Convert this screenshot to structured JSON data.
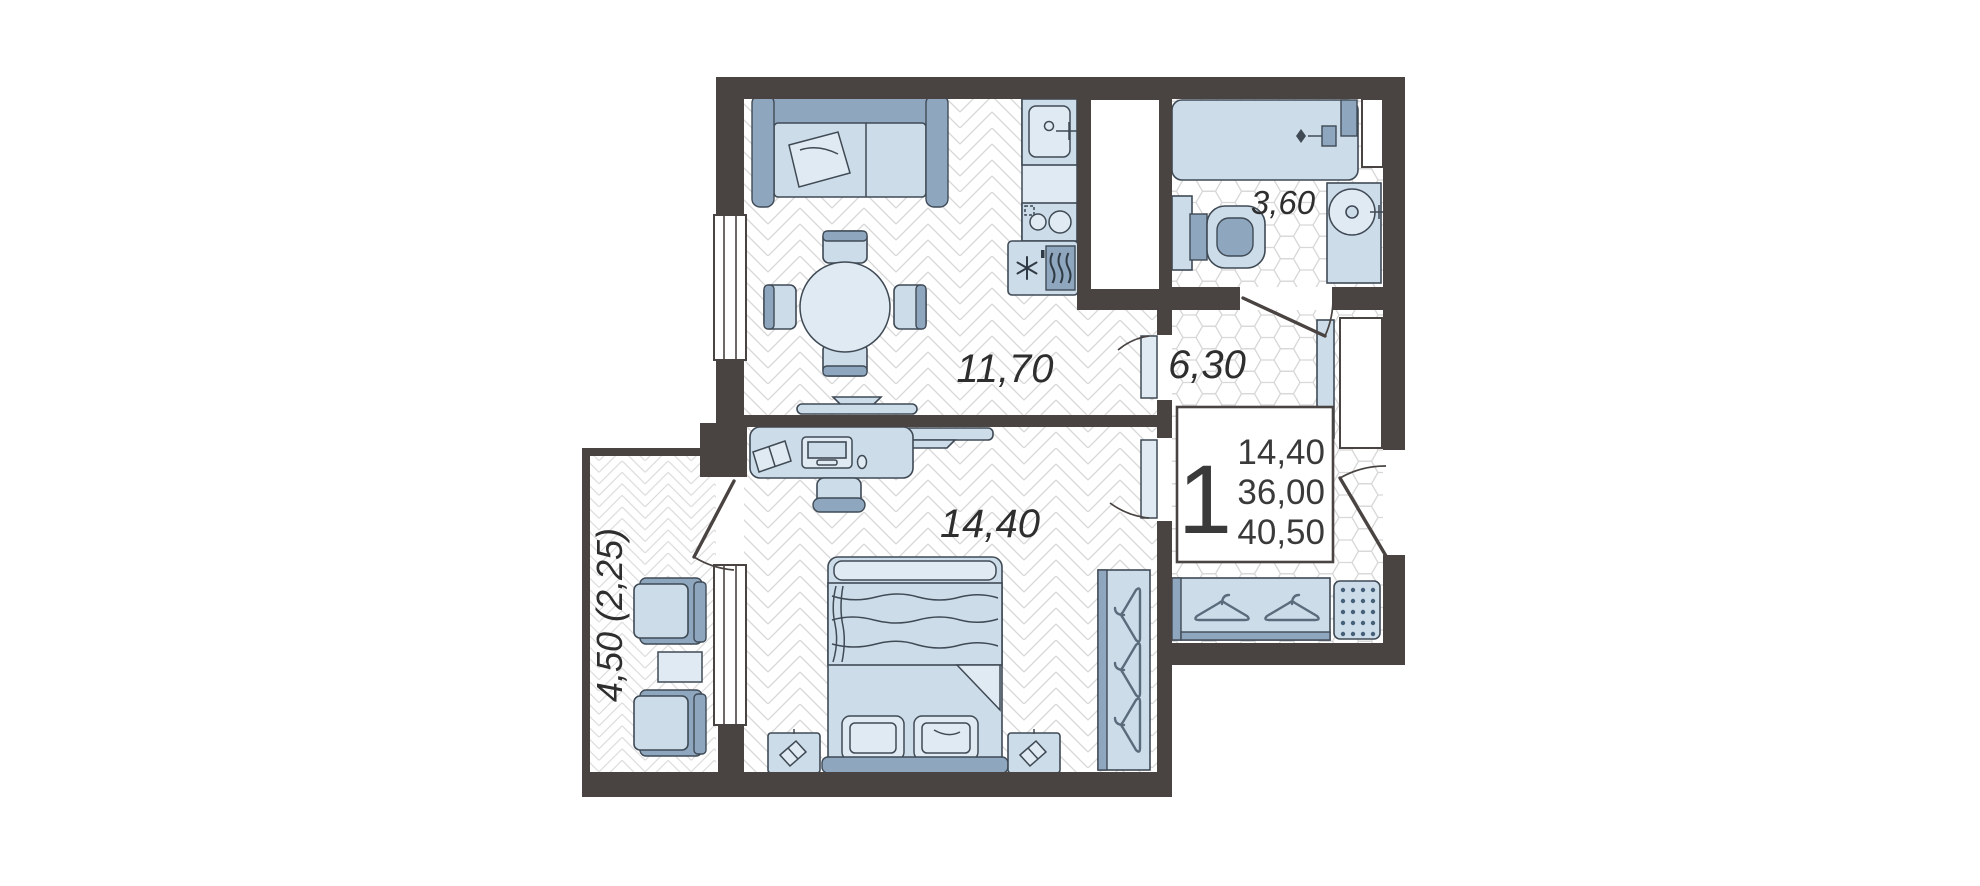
{
  "plan": {
    "rooms": {
      "kitchen_living": {
        "area_label": "11,70"
      },
      "hallway": {
        "area_label": "6,30"
      },
      "bathroom": {
        "area_label": "3,60"
      },
      "bedroom": {
        "area_label": "14,40"
      },
      "balcony": {
        "area_label": "4,50 (2,25)"
      }
    },
    "summary_box": {
      "rooms_count": "1",
      "living_area": "14,40",
      "area": "36,00",
      "total_area": "40,50"
    },
    "colors": {
      "wall": "#494341",
      "outline": "#3f4a55",
      "furn": "#ccdce9",
      "furnl": "#e0eaf2",
      "accent": "#8fa6bf",
      "text": "#2e2e2e"
    }
  }
}
